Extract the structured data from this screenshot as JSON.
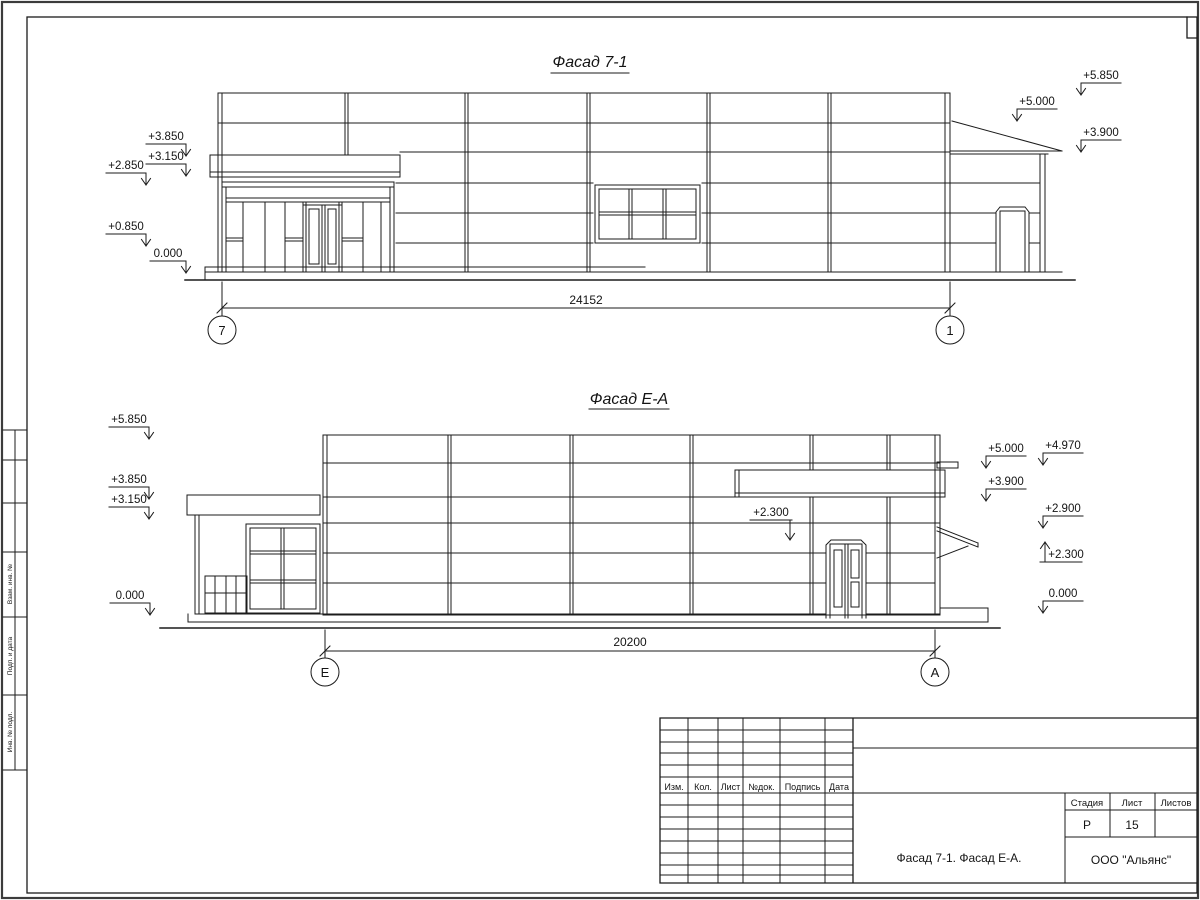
{
  "facade1": {
    "title": "Фасад 7-1",
    "dimension": "24152",
    "axis_left": "7",
    "axis_right": "1",
    "marks": {
      "left": [
        "+3.850",
        "+3.150",
        "+2.850",
        "+0.850",
        "0.000"
      ],
      "right": [
        "+5.850",
        "+5.000",
        "+3.900"
      ]
    }
  },
  "facade2": {
    "title": "Фасад Е-А",
    "dimension": "20200",
    "axis_left": "Е",
    "axis_right": "А",
    "marks": {
      "left": [
        "+5.850",
        "+3.850",
        "+3.150",
        "0.000"
      ],
      "middle": "+2.300",
      "right_inner": [
        "+5.000",
        "+3.900"
      ],
      "right_outer": [
        "+4.970",
        "+2.900",
        "+2.300",
        "0.000"
      ]
    }
  },
  "margin_labels": [
    "Взам. инв. №",
    "Подп. и дата",
    "Инв. № подл."
  ],
  "titleblock": {
    "rev_headers": [
      "Изм.",
      "Кол.",
      "Лист",
      "№док.",
      "Подпись",
      "Дата"
    ],
    "stage_label": "Стадия",
    "sheet_label": "Лист",
    "sheets_label": "Листов",
    "stage": "Р",
    "sheet": "15",
    "sheets": "",
    "title": "Фасад 7-1. Фасад Е-А.",
    "company": "ООО \"Альянс\""
  }
}
